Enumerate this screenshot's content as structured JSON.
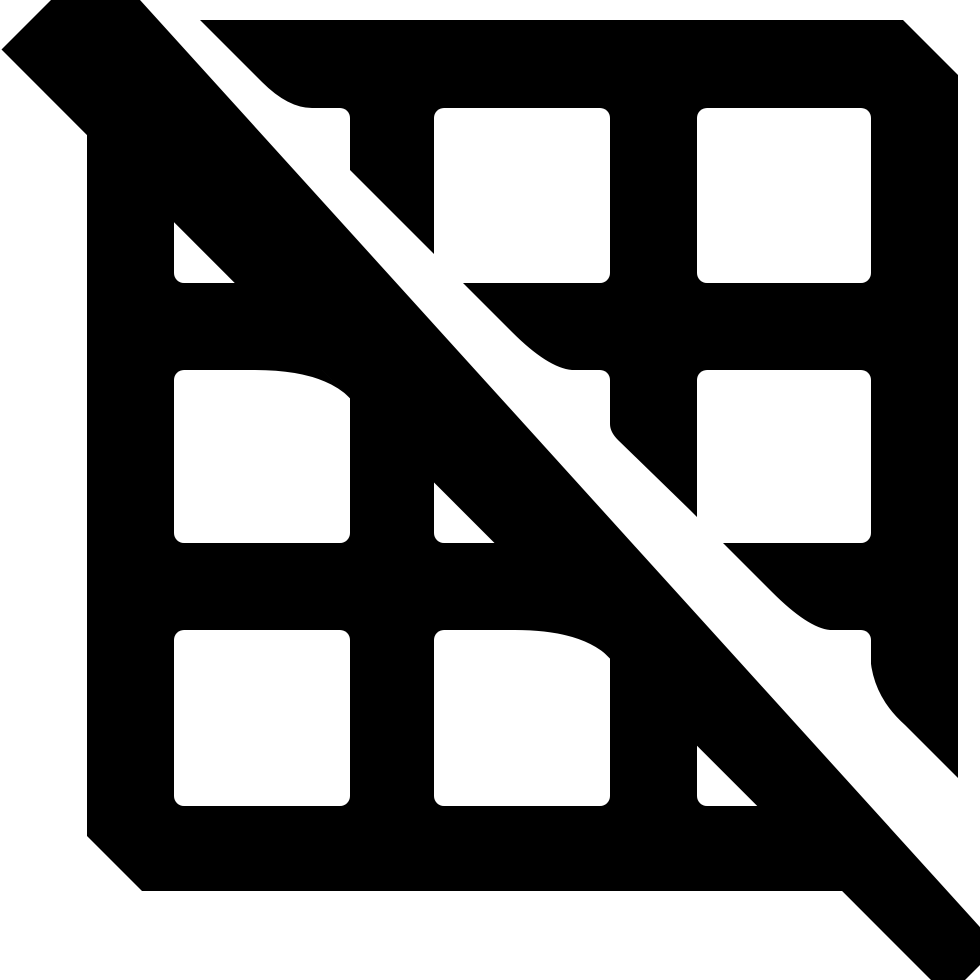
{
  "page": {
    "title": "Grid off icon"
  },
  "icon": {
    "name": "grid-off",
    "label": "Grid disabled icon",
    "description": "A 3x3 grid table symbol crossed out by a thick diagonal slash running from the top-left corner to the bottom-right corner, with a white gap separating the slash from the grid",
    "grid_rows": 3,
    "grid_columns": 3
  },
  "colors": {
    "foreground": "#000000",
    "background": "#ffffff"
  }
}
